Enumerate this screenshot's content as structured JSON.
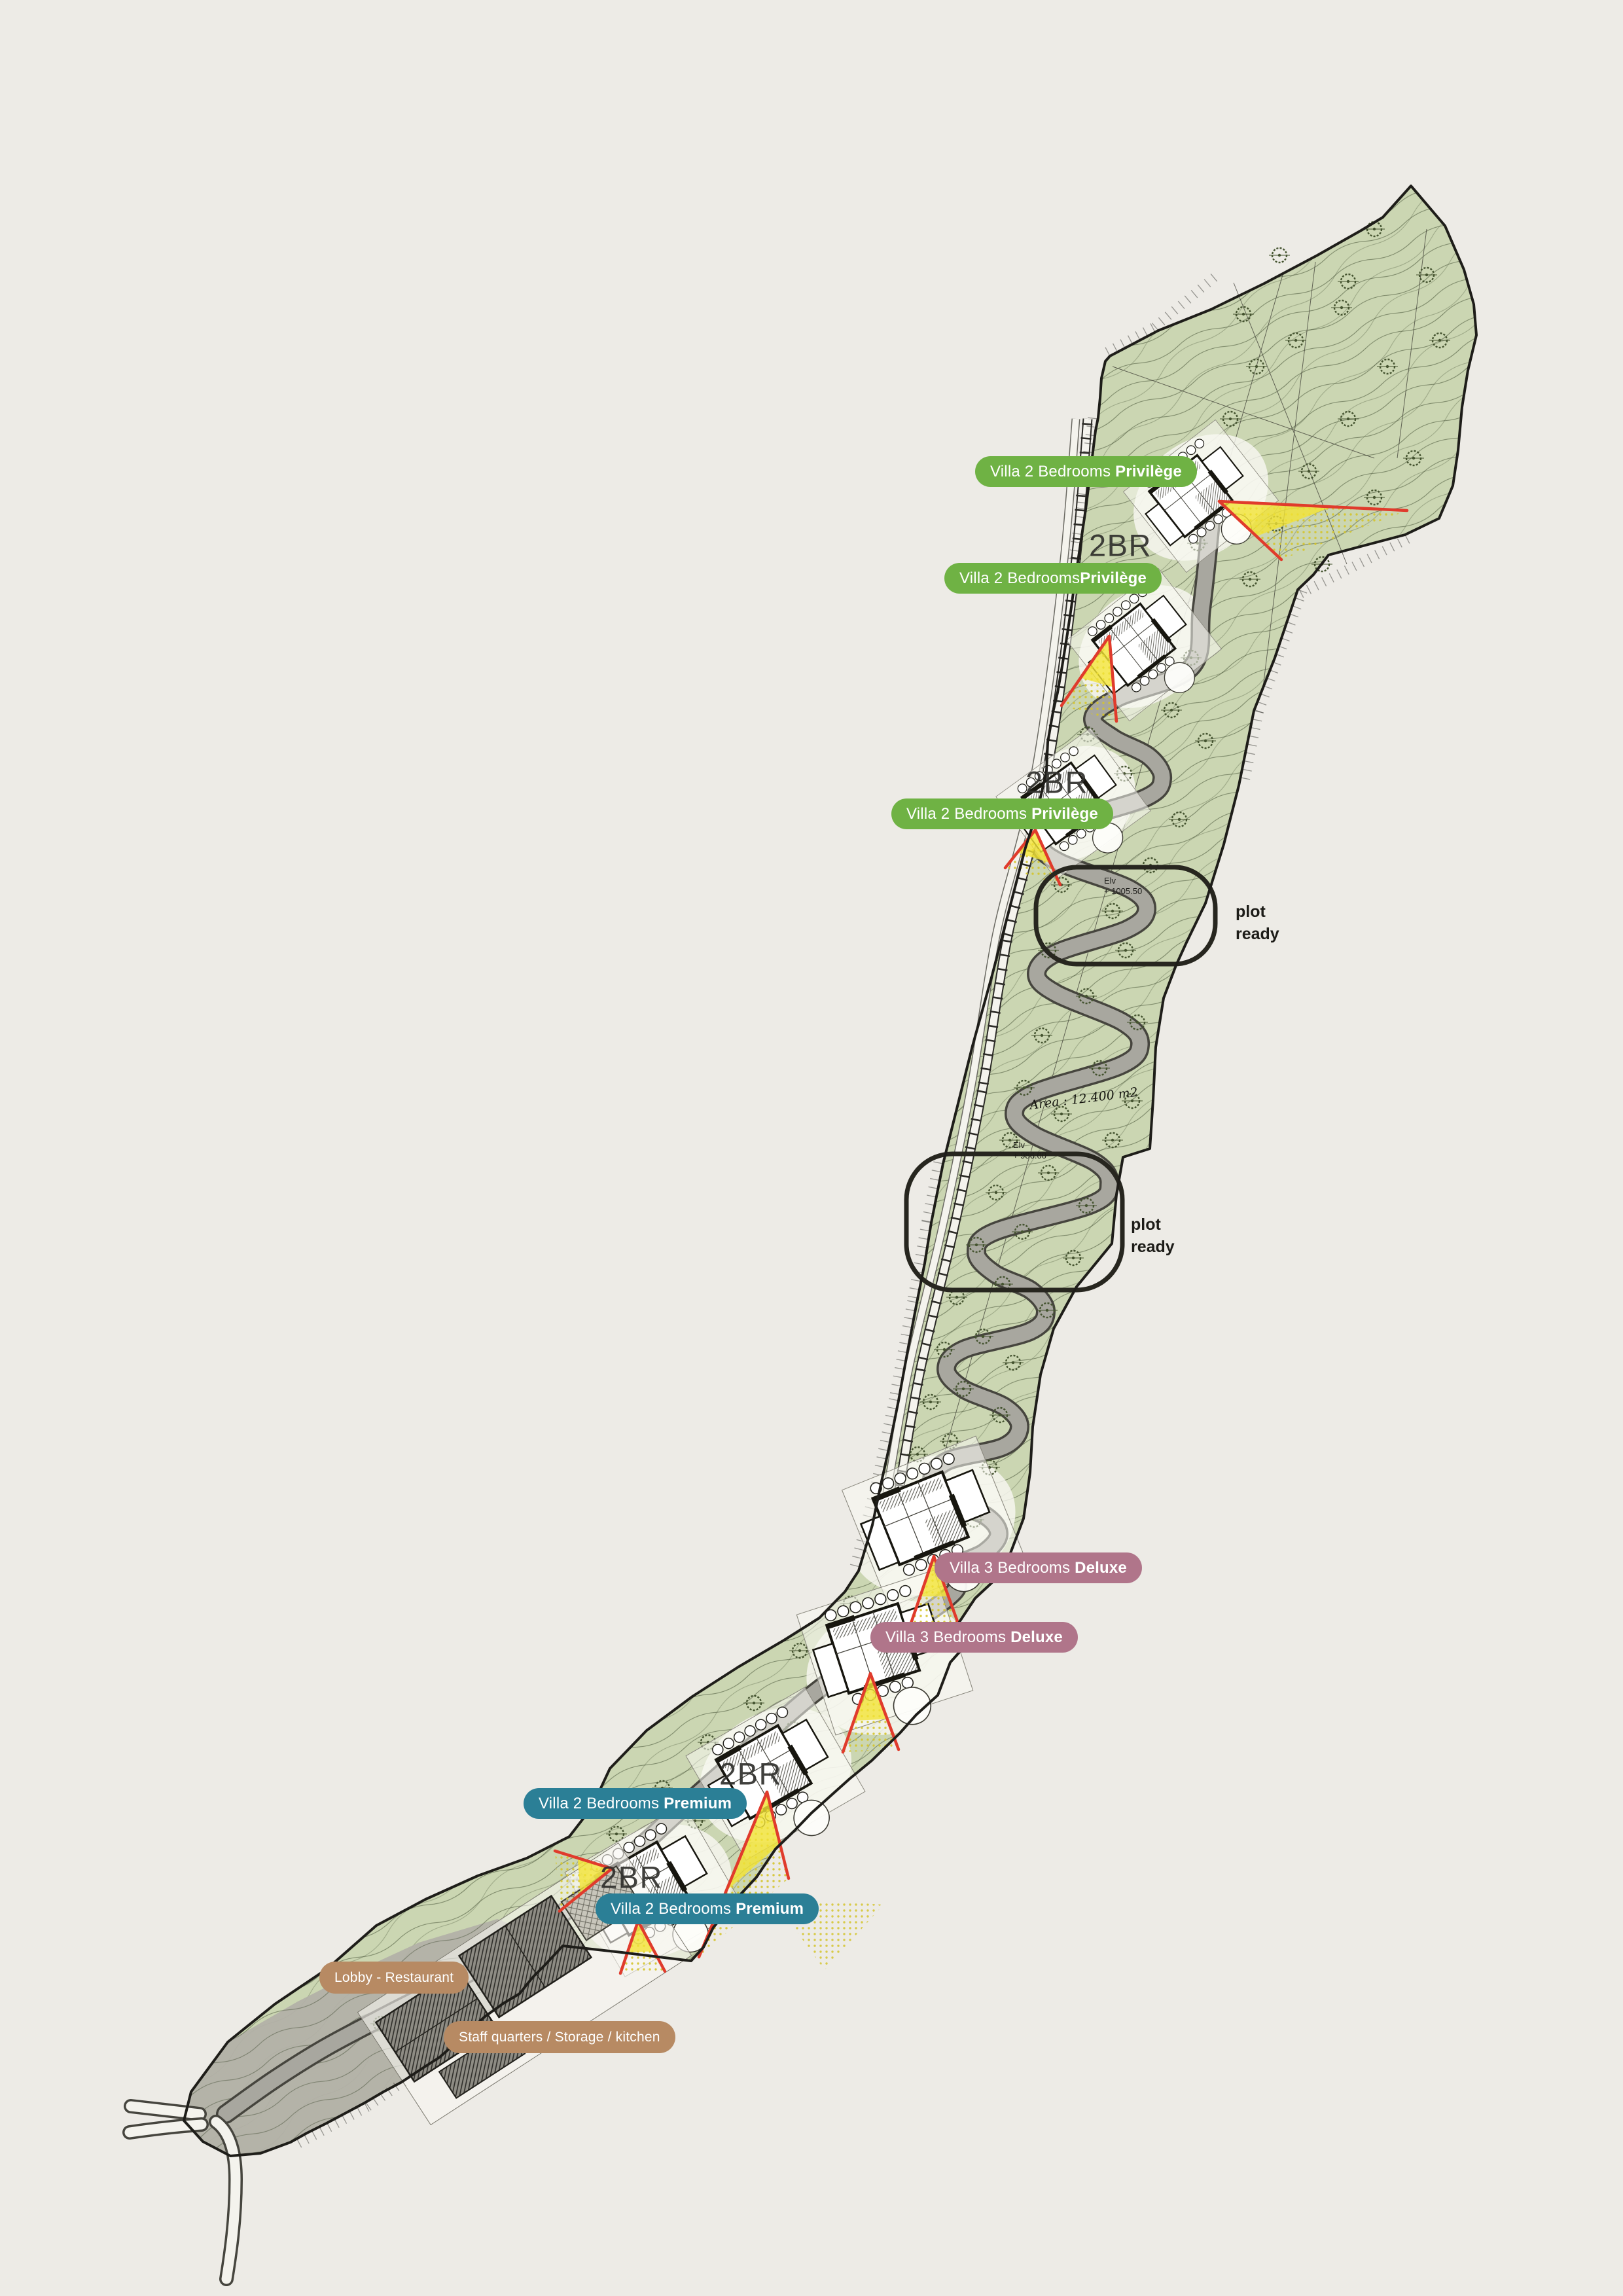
{
  "title": "Resort site master plan",
  "palette": {
    "background": "#edebe6",
    "site_green": "#cbd6b2",
    "contour": "#3f5231",
    "road_fill": "#a8a79f",
    "road_edge": "#46453e",
    "boundary": "#1e1d19",
    "funicular_white": "#f4f3ed",
    "tie_dark": "#2c2b27",
    "tree_green": "#44532f",
    "view_red": "#e03b2c",
    "view_yellow": "#f2e435",
    "gray_tail": "#b2b0a7",
    "pad_white": "#f8f7f1",
    "pill_green": "#6fb244",
    "pill_mauve": "#b0758a",
    "pill_teal": "#2b7f96",
    "pill_tan": "#b78a63",
    "text_dark": "#22221e"
  },
  "labels": [
    {
      "id": "privilege-1",
      "text_normal": "Villa 2 Bedrooms ",
      "text_bold": "Privilège",
      "style": "green"
    },
    {
      "id": "privilege-2",
      "text_normal": "Villa 2 Bedrooms",
      "text_bold": "Privilège",
      "style": "green"
    },
    {
      "id": "privilege-3",
      "text_normal": "Villa 2 Bedrooms ",
      "text_bold": "Privilège",
      "style": "green"
    },
    {
      "id": "deluxe-1",
      "text_normal": "Villa 3 Bedrooms ",
      "text_bold": "Deluxe",
      "style": "mauve"
    },
    {
      "id": "deluxe-2",
      "text_normal": "Villa 3 Bedrooms ",
      "text_bold": "Deluxe",
      "style": "mauve"
    },
    {
      "id": "premium-1",
      "text_normal": "Villa 2 Bedrooms ",
      "text_bold": "Premium",
      "style": "teal"
    },
    {
      "id": "premium-2",
      "text_normal": "Villa 2 Bedrooms ",
      "text_bold": "Premium",
      "style": "teal"
    },
    {
      "id": "lobby",
      "text_normal": "Lobby - Restaurant",
      "text_bold": "",
      "style": "tan"
    },
    {
      "id": "staff",
      "text_normal": "Staff quarters / Storage / kitchen",
      "text_bold": "",
      "style": "tan"
    }
  ],
  "plot_ready": [
    {
      "line1": "plot",
      "line2": "ready"
    },
    {
      "line1": "plot",
      "line2": "ready"
    }
  ],
  "annotations": {
    "unit_tags": [
      "2BR",
      "2BR",
      "2BR",
      "2BR"
    ],
    "area_note": "Area : 12.400 m2",
    "elevations": [
      {
        "label": "Elv",
        "value": "+ 1005.50"
      },
      {
        "label": "Elv",
        "value": "+ 986.00"
      }
    ]
  }
}
